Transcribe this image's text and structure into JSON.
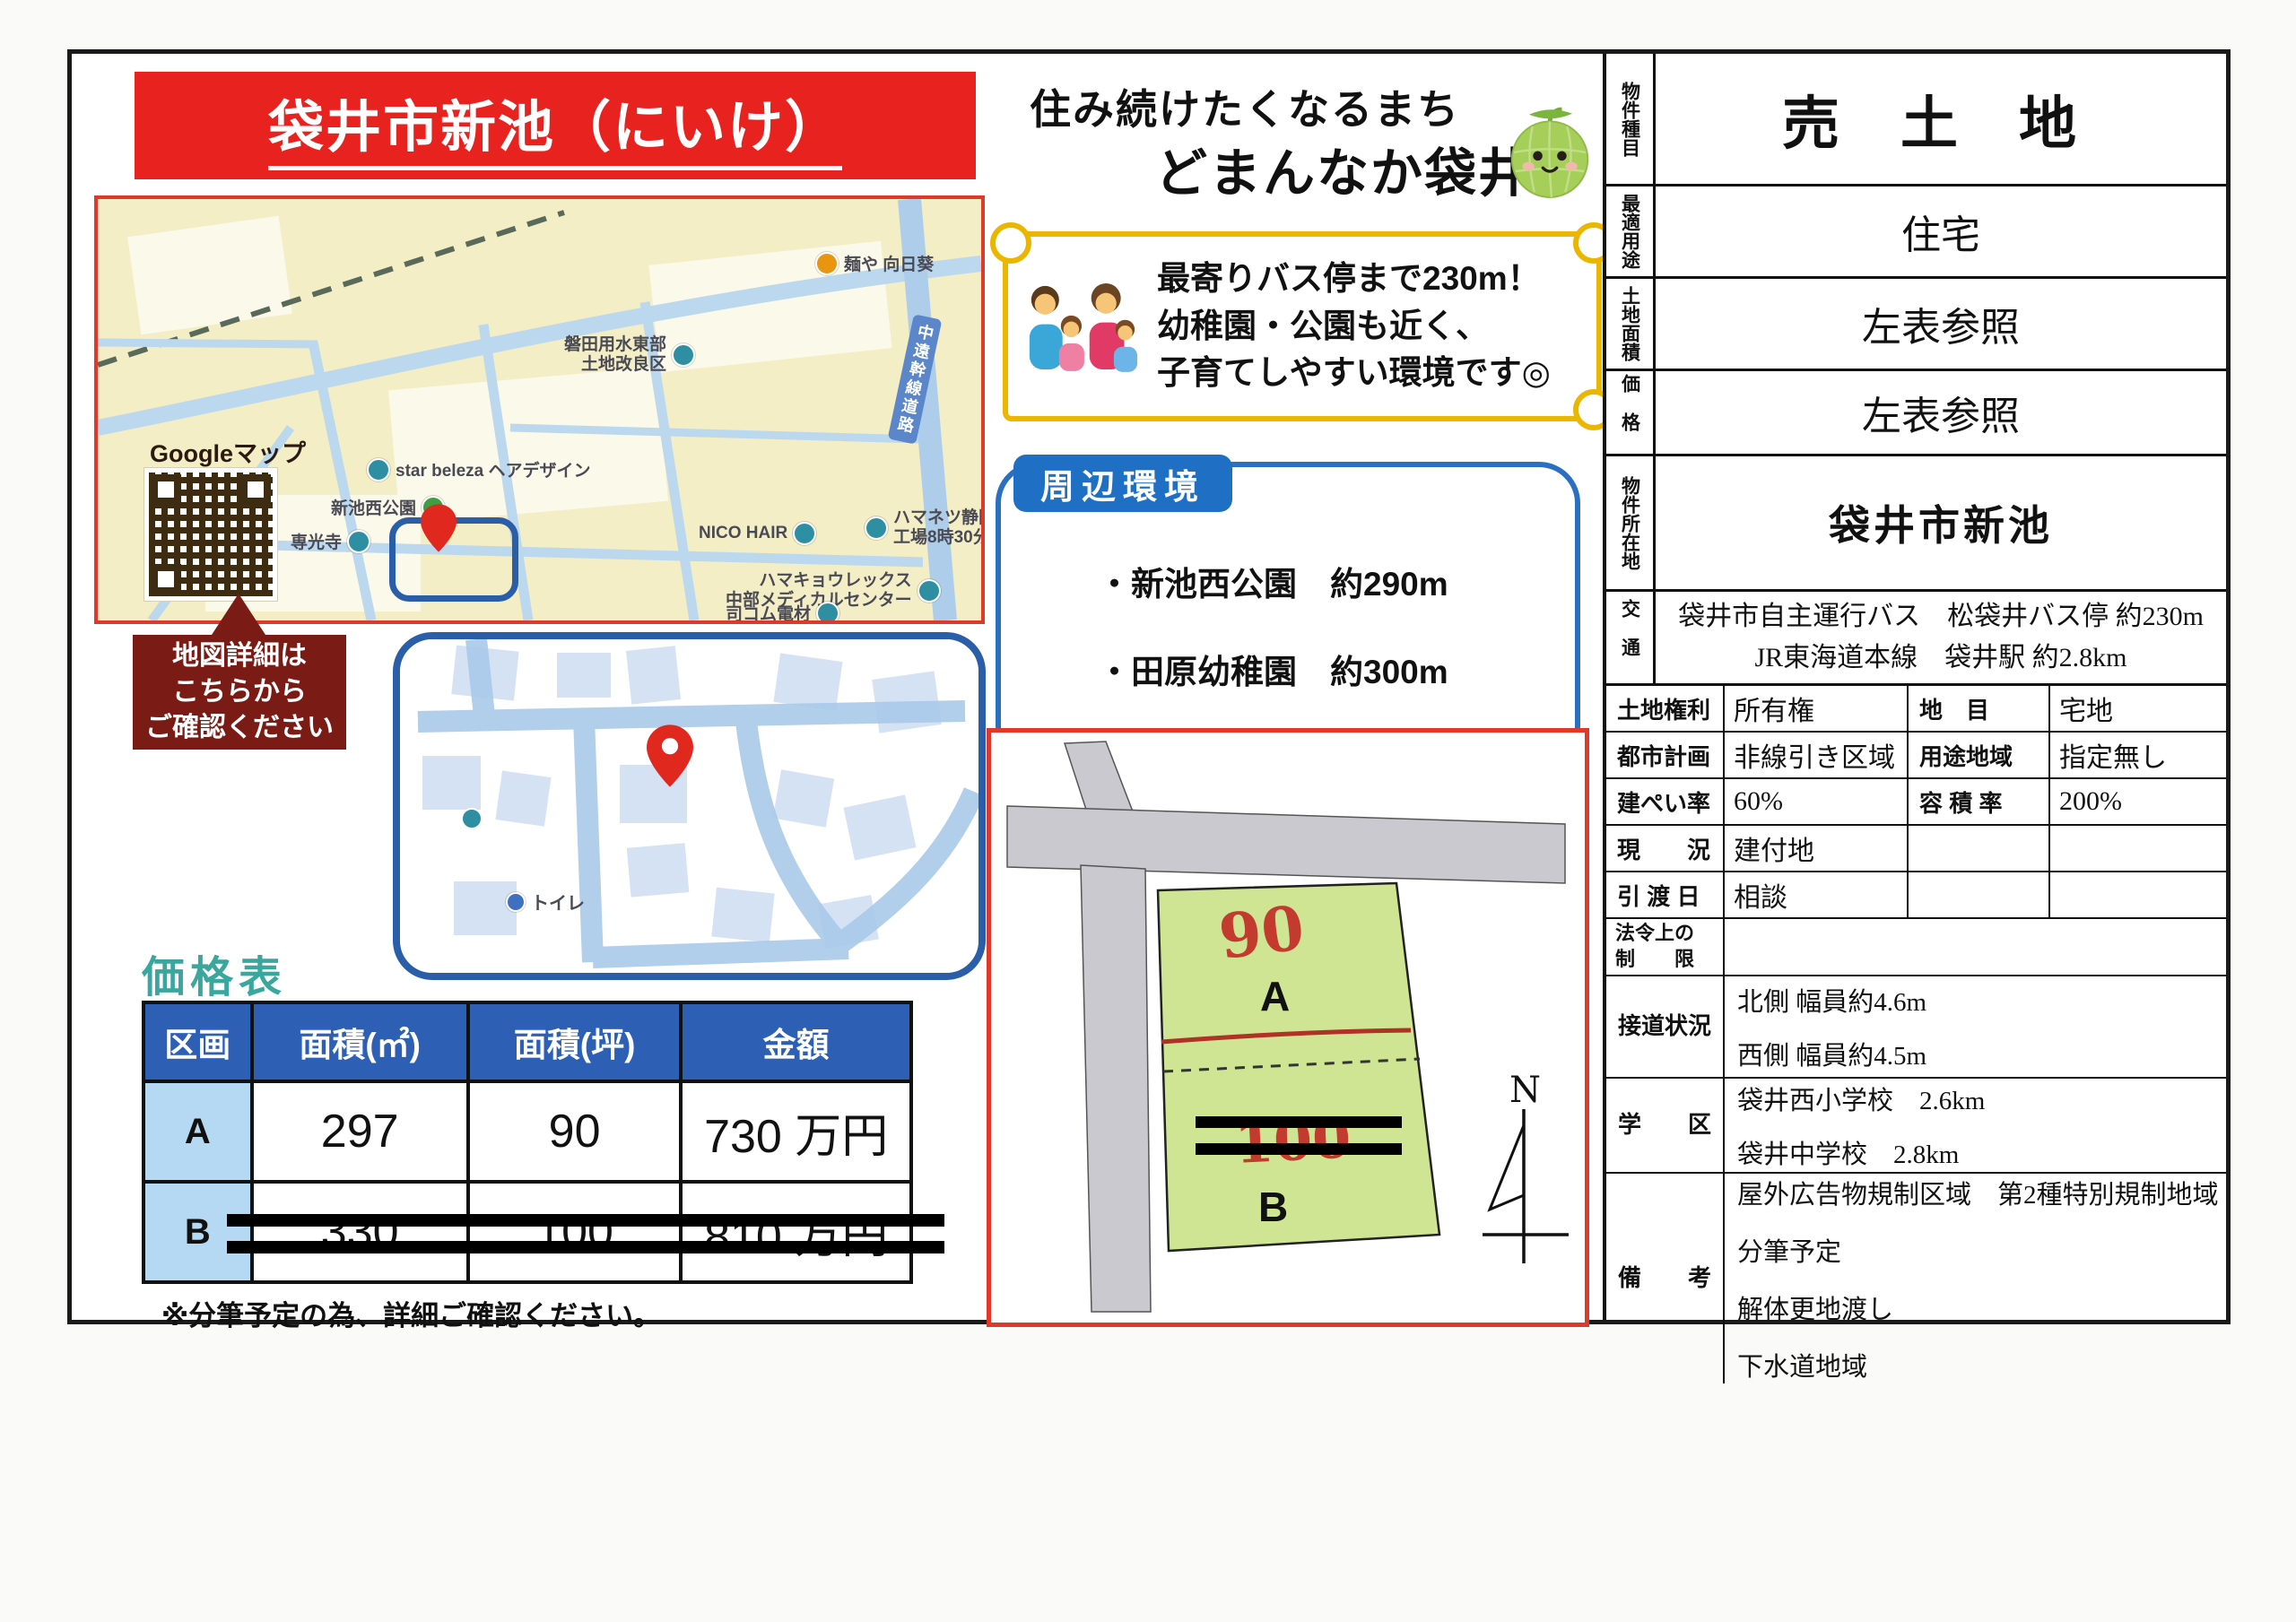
{
  "title": "袋井市新池（にいけ）",
  "catchphrase": {
    "line1": "住み続けたくなるまち",
    "line2": "どまんなか袋井"
  },
  "scroll_banner": {
    "line1": "最寄りバス停まで230m！",
    "line2": "幼稚園・公園も近く、",
    "line3": "子育てしやすい環境です◎"
  },
  "big_map": {
    "google_label": "Googleマップ",
    "labels": {
      "ramen": "麺や 向日葵",
      "irrigation1": "磐田用水東部",
      "irrigation2": "土地改良区",
      "hair_salon": "star beleza ヘアデザイン",
      "park": "新池西公園",
      "nico": "NICO HAIR",
      "hamanetsu1": "ハマネツ静岡",
      "hamanetsu2": "工場8時30分",
      "hamakyo1": "ハマキョウレックス",
      "hamakyo2": "中部メディカルセンター",
      "denzai": "司コム電材",
      "temple": "専光寺",
      "road": "中遠幹線道路"
    }
  },
  "map_callout": {
    "line1": "地図詳細は",
    "line2": "こちらから",
    "line3": "ご確認ください"
  },
  "inset_map": {
    "toilet": "トイレ"
  },
  "surroundings": {
    "title": "周辺環境",
    "items": [
      "・新池西公園　約290m",
      "・田原幼稚園　約300m",
      "・ピアゴ袋井店　約2.2km"
    ]
  },
  "price_table": {
    "heading": "価格表",
    "headers": [
      "区画",
      "面積(㎡)",
      "面積(坪)",
      "金額"
    ],
    "rows": [
      {
        "plot": "A",
        "m2": "297",
        "tsubo": "90",
        "price": "730 万円"
      },
      {
        "plot": "B",
        "m2": "330",
        "tsubo": "100",
        "price": "810 万円"
      }
    ],
    "note": "※分筆予定の為、詳細ご確認ください。"
  },
  "plot_diagram": {
    "a_value": "90",
    "a_label": "A",
    "b_value": "100",
    "b_label": "B",
    "north": "N"
  },
  "property": {
    "type_label": "物件種目",
    "type": "売 土 地",
    "use_label": "最適用途",
    "use": "住宅",
    "area_label": "土地面積",
    "area": "左表参照",
    "price_label": "価格",
    "price": "左表参照",
    "location_label": "物件所在地",
    "location": "袋井市新池",
    "access_label": "交通",
    "access1": "袋井市自主運行バス　松袋井バス停 約230m",
    "access2": "JR東海道本線　袋井駅 約2.8km",
    "rows": [
      {
        "l1": "土地権利",
        "v1": "所有権",
        "l2": "地　目",
        "v2": "宅地"
      },
      {
        "l1": "都市計画",
        "v1": "非線引き区域",
        "l2": "用途地域",
        "v2": "指定無し"
      },
      {
        "l1": "建ぺい率",
        "v1": "60%",
        "l2": "容 積 率",
        "v2": "200%"
      },
      {
        "l1": "現　　況",
        "v1": "建付地",
        "l2": "",
        "v2": ""
      },
      {
        "l1": "引 渡 日",
        "v1": "相談",
        "l2": "",
        "v2": ""
      }
    ],
    "legal_label1": "法令上の",
    "legal_label2": "制　　限",
    "road_label": "接道状況",
    "road1": "北側 幅員約4.6m",
    "road2": "西側 幅員約4.5m",
    "school_label": "学　　区",
    "school1": "袋井西小学校　2.6km",
    "school2": "袋井中学校　2.8km",
    "notes_label": "備　　考",
    "notes": [
      "屋外広告物規制区域　第2種特別規制地域",
      "分筆予定",
      "解体更地渡し",
      "下水道地域"
    ]
  }
}
